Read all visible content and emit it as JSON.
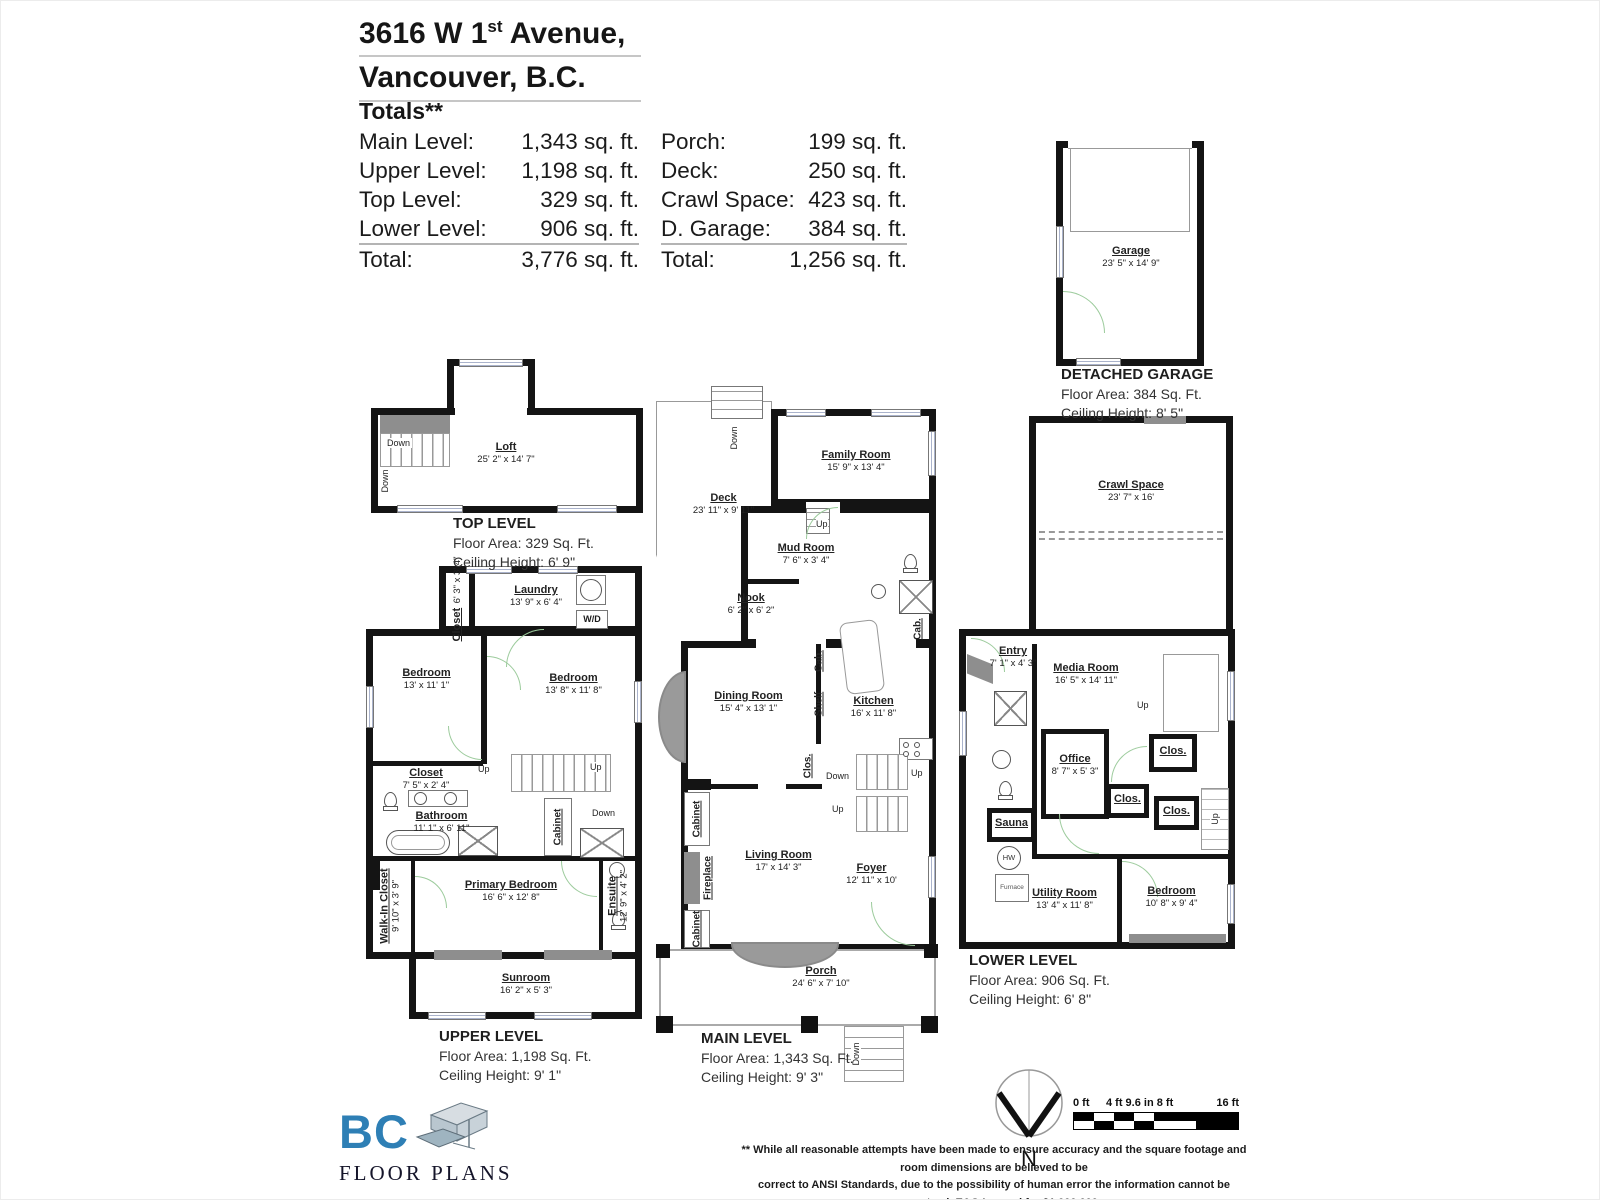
{
  "header": {
    "address_line1_pre": "3616 W 1",
    "address_line1_sup": "st",
    "address_line1_post": " Avenue,",
    "address_line2": "Vancouver, B.C.",
    "totals_heading": "Totals**",
    "totals_left": [
      {
        "label": "Main Level:",
        "value": "1,343 sq. ft."
      },
      {
        "label": "Upper Level:",
        "value": "1,198 sq. ft."
      },
      {
        "label": "Top Level:",
        "value": "329 sq. ft."
      },
      {
        "label": "Lower Level:",
        "value": "906 sq. ft."
      },
      {
        "label": "Total:",
        "value": "3,776 sq. ft."
      }
    ],
    "totals_right": [
      {
        "label": "Porch:",
        "value": "199 sq. ft."
      },
      {
        "label": "Deck:",
        "value": "250 sq. ft."
      },
      {
        "label": "Crawl Space:",
        "value": "423 sq. ft."
      },
      {
        "label": "D. Garage:",
        "value": "384 sq. ft."
      },
      {
        "label": "Total:",
        "value": "1,256 sq. ft."
      }
    ]
  },
  "levels": {
    "top": {
      "title": "TOP LEVEL",
      "area": "Floor Area: 329 Sq. Ft.",
      "ceiling": "Ceiling Height: 6' 9\""
    },
    "upper": {
      "title": "UPPER LEVEL",
      "area": "Floor Area: 1,198 Sq. Ft.",
      "ceiling": "Ceiling Height: 9' 1\""
    },
    "main": {
      "title": "MAIN LEVEL",
      "area": "Floor Area: 1,343 Sq. Ft.",
      "ceiling": "Ceiling Height: 9' 3\""
    },
    "lower": {
      "title": "LOWER LEVEL",
      "area": "Floor Area: 906 Sq. Ft.",
      "ceiling": "Ceiling Height: 6' 8\""
    },
    "garage": {
      "title": "DETACHED GARAGE",
      "area": "Floor Area: 384 Sq. Ft.",
      "ceiling": "Ceiling Height: 8' 5\""
    }
  },
  "rooms": {
    "loft": {
      "name": "Loft",
      "dims": "25' 2\" x 14' 7\""
    },
    "closet_top": {
      "name": "Closet",
      "dims": "6' 3\" x 3' 4\""
    },
    "laundry": {
      "name": "Laundry",
      "dims": "13' 9\" x 6' 4\""
    },
    "bedroom_u1": {
      "name": "Bedroom",
      "dims": "13' x 11' 1\""
    },
    "bedroom_u2": {
      "name": "Bedroom",
      "dims": "13' 8\" x 11' 8\""
    },
    "closet_mid": {
      "name": "Closet",
      "dims": "7' 5\" x 2' 4\""
    },
    "bathroom": {
      "name": "Bathroom",
      "dims": "11' 1\" x 6' 11\""
    },
    "walk_in": {
      "name": "Walk-In Closet",
      "dims": "9' 10\" x 3' 9\""
    },
    "primary": {
      "name": "Primary Bedroom",
      "dims": "16' 6\" x 12' 8\""
    },
    "ensuite": {
      "name": "Ensuite",
      "dims": "12' 9\" x 4' 2\""
    },
    "sunroom": {
      "name": "Sunroom",
      "dims": "16' 2\" x 5' 3\""
    },
    "deck": {
      "name": "Deck",
      "dims": "23' 11\" x 9' 11\""
    },
    "family": {
      "name": "Family Room",
      "dims": "15' 9\" x 13' 4\""
    },
    "mudroom": {
      "name": "Mud Room",
      "dims": "7' 6\" x 3' 4\""
    },
    "nook": {
      "name": "Nook",
      "dims": "6' 2\" x 6' 2\""
    },
    "dining": {
      "name": "Dining Room",
      "dims": "15' 4\" x 13' 1\""
    },
    "kitchen": {
      "name": "Kitchen",
      "dims": "16' x 11' 8\""
    },
    "living": {
      "name": "Living Room",
      "dims": "17' x 14' 3\""
    },
    "foyer": {
      "name": "Foyer",
      "dims": "12' 11\" x 10'"
    },
    "porch": {
      "name": "Porch",
      "dims": "24' 6\" x 7' 10\""
    },
    "garage": {
      "name": "Garage",
      "dims": "23' 5\" x 14' 9\""
    },
    "crawl": {
      "name": "Crawl Space",
      "dims": "23' 7\" x 16'"
    },
    "entry": {
      "name": "Entry",
      "dims": "7' 1\" x 4' 3\""
    },
    "media": {
      "name": "Media Room",
      "dims": "16' 5\" x 14' 11\""
    },
    "office": {
      "name": "Office",
      "dims": "8' 7\" x 5' 3\""
    },
    "utility": {
      "name": "Utility Room",
      "dims": "13' 4\" x 11' 8\""
    },
    "bedroom_l": {
      "name": "Bedroom",
      "dims": "10' 8\" x 9' 4\""
    }
  },
  "labels": {
    "up": "Up",
    "down": "Down",
    "wd": "W/D",
    "cab": "Cab.",
    "shelf": "Shelf",
    "clos": "Clos.",
    "cabinet": "Cabinet",
    "fireplace": "Fireplace",
    "sauna": "Sauna",
    "hw": "HW",
    "furnace": "Furnace"
  },
  "footer": {
    "logo_bc": "BC",
    "logo_text": "FLOOR PLANS",
    "north_label": "N",
    "scale_left": "0 ft",
    "scale_mid": "4 ft 9.6 in 8 ft",
    "scale_right": "16 ft",
    "disclaimer_line1": "** While all reasonable attempts have been made to ensure accuracy and the square footage and room dimensions are believed to be",
    "disclaimer_line2": "correct to ANSI Standards, due to the possibility of human error the information cannot be guaranteed. E&O Insured for $1,000,000"
  },
  "colors": {
    "wall": "#141414",
    "door_green": "#9ccb9c",
    "window_blue": "#aab3cc",
    "gray_fill": "#8e8e8e",
    "logo_blue": "#2e7fb5"
  }
}
